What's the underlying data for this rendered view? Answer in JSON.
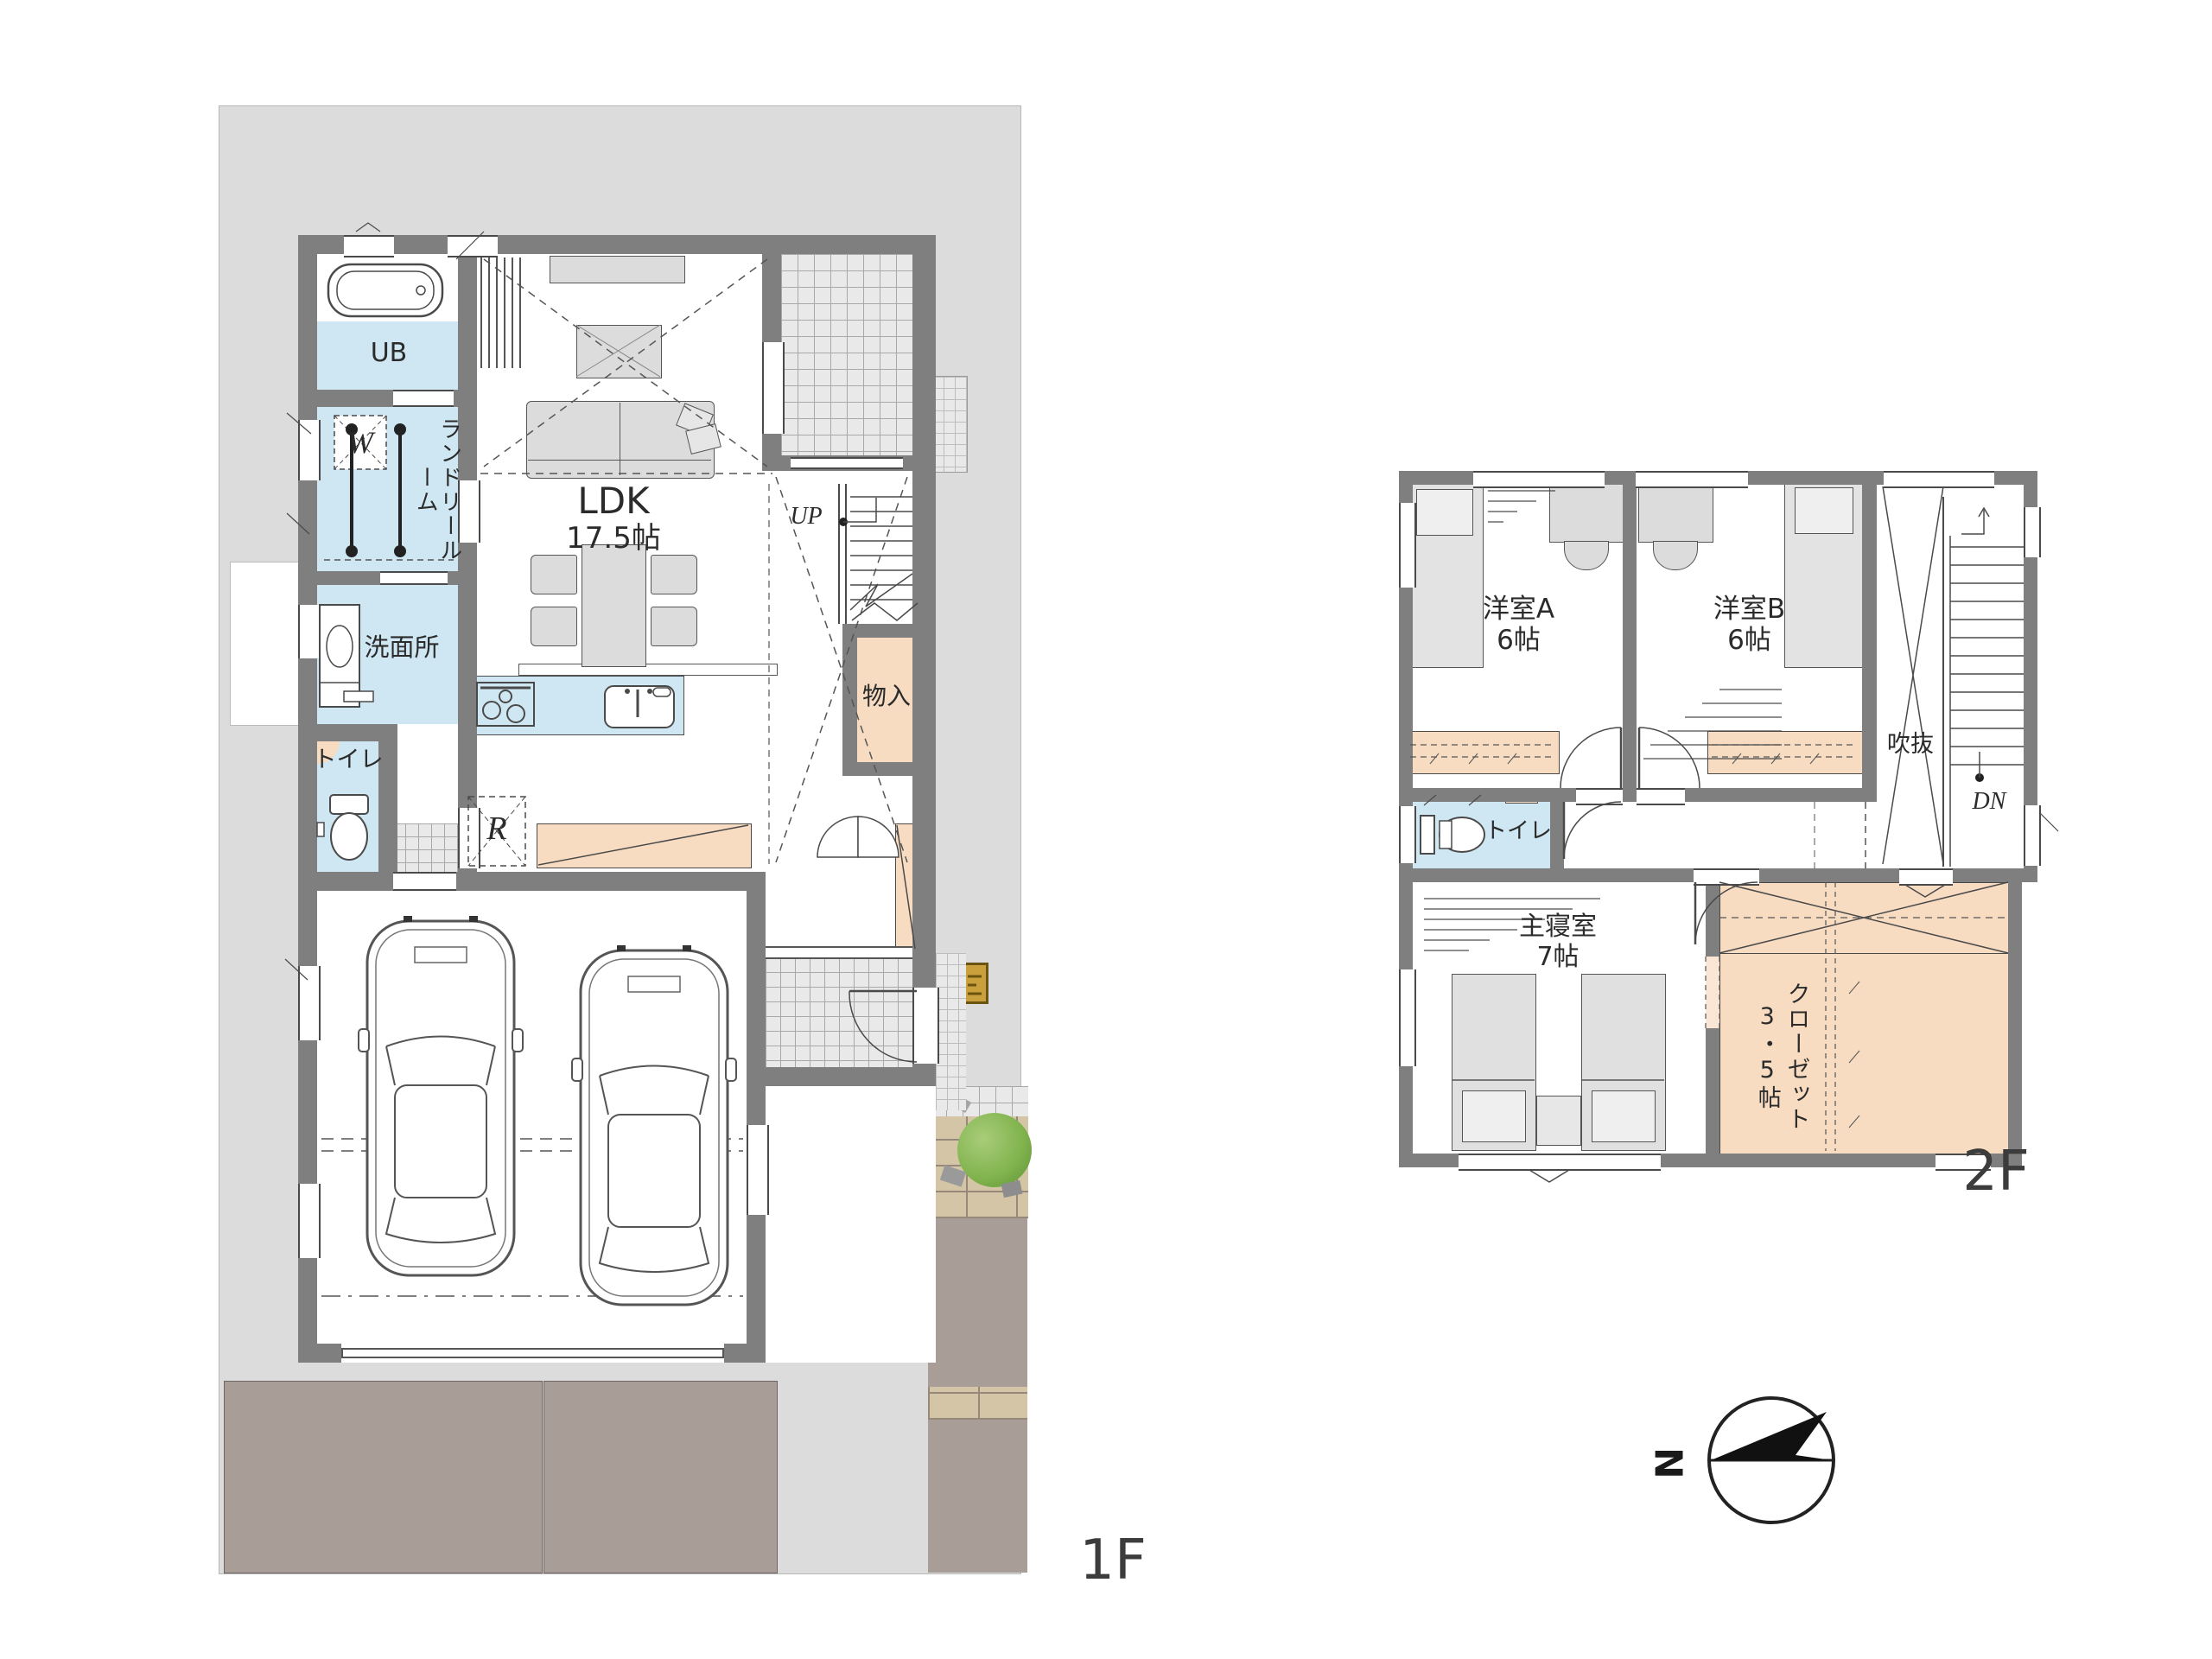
{
  "title": "house floor plan 1F/2F",
  "colors": {
    "site": "#dcdcdd",
    "wall": "#7f7f7f",
    "water_room": "#cfe7f2",
    "storage_room": "#f7dcc2",
    "furniture": "#dcdcdc",
    "tile_floor": "#e9e9ea",
    "driveway": "#a89d97",
    "brick": "#d3c5a5",
    "bush": "#7fb24c",
    "meter_box": "#c9a03b",
    "line": "#3f3f3f"
  },
  "f1": {
    "floor_label": "1F",
    "ub": "UB",
    "laundry_col1": "ランドリー",
    "laundry_col2": "ルーム",
    "washroom": "洗面所",
    "toilet": "トイレ",
    "ldk": "LDK",
    "ldk_size": "17.5帖",
    "storage": "物入",
    "washer_mark": "W",
    "fridge_mark": "R",
    "up_mark": "UP"
  },
  "f2": {
    "floor_label": "2F",
    "room_a": "洋室A",
    "room_a_size": "6帖",
    "room_b": "洋室B",
    "room_b_size": "6帖",
    "void": "吹抜",
    "dn_mark": "DN",
    "toilet": "トイレ",
    "master": "主寝室",
    "master_size": "7帖",
    "closet_col1": "クローゼット",
    "closet_col2": "3・5帖"
  },
  "compass": {
    "north": "N"
  }
}
